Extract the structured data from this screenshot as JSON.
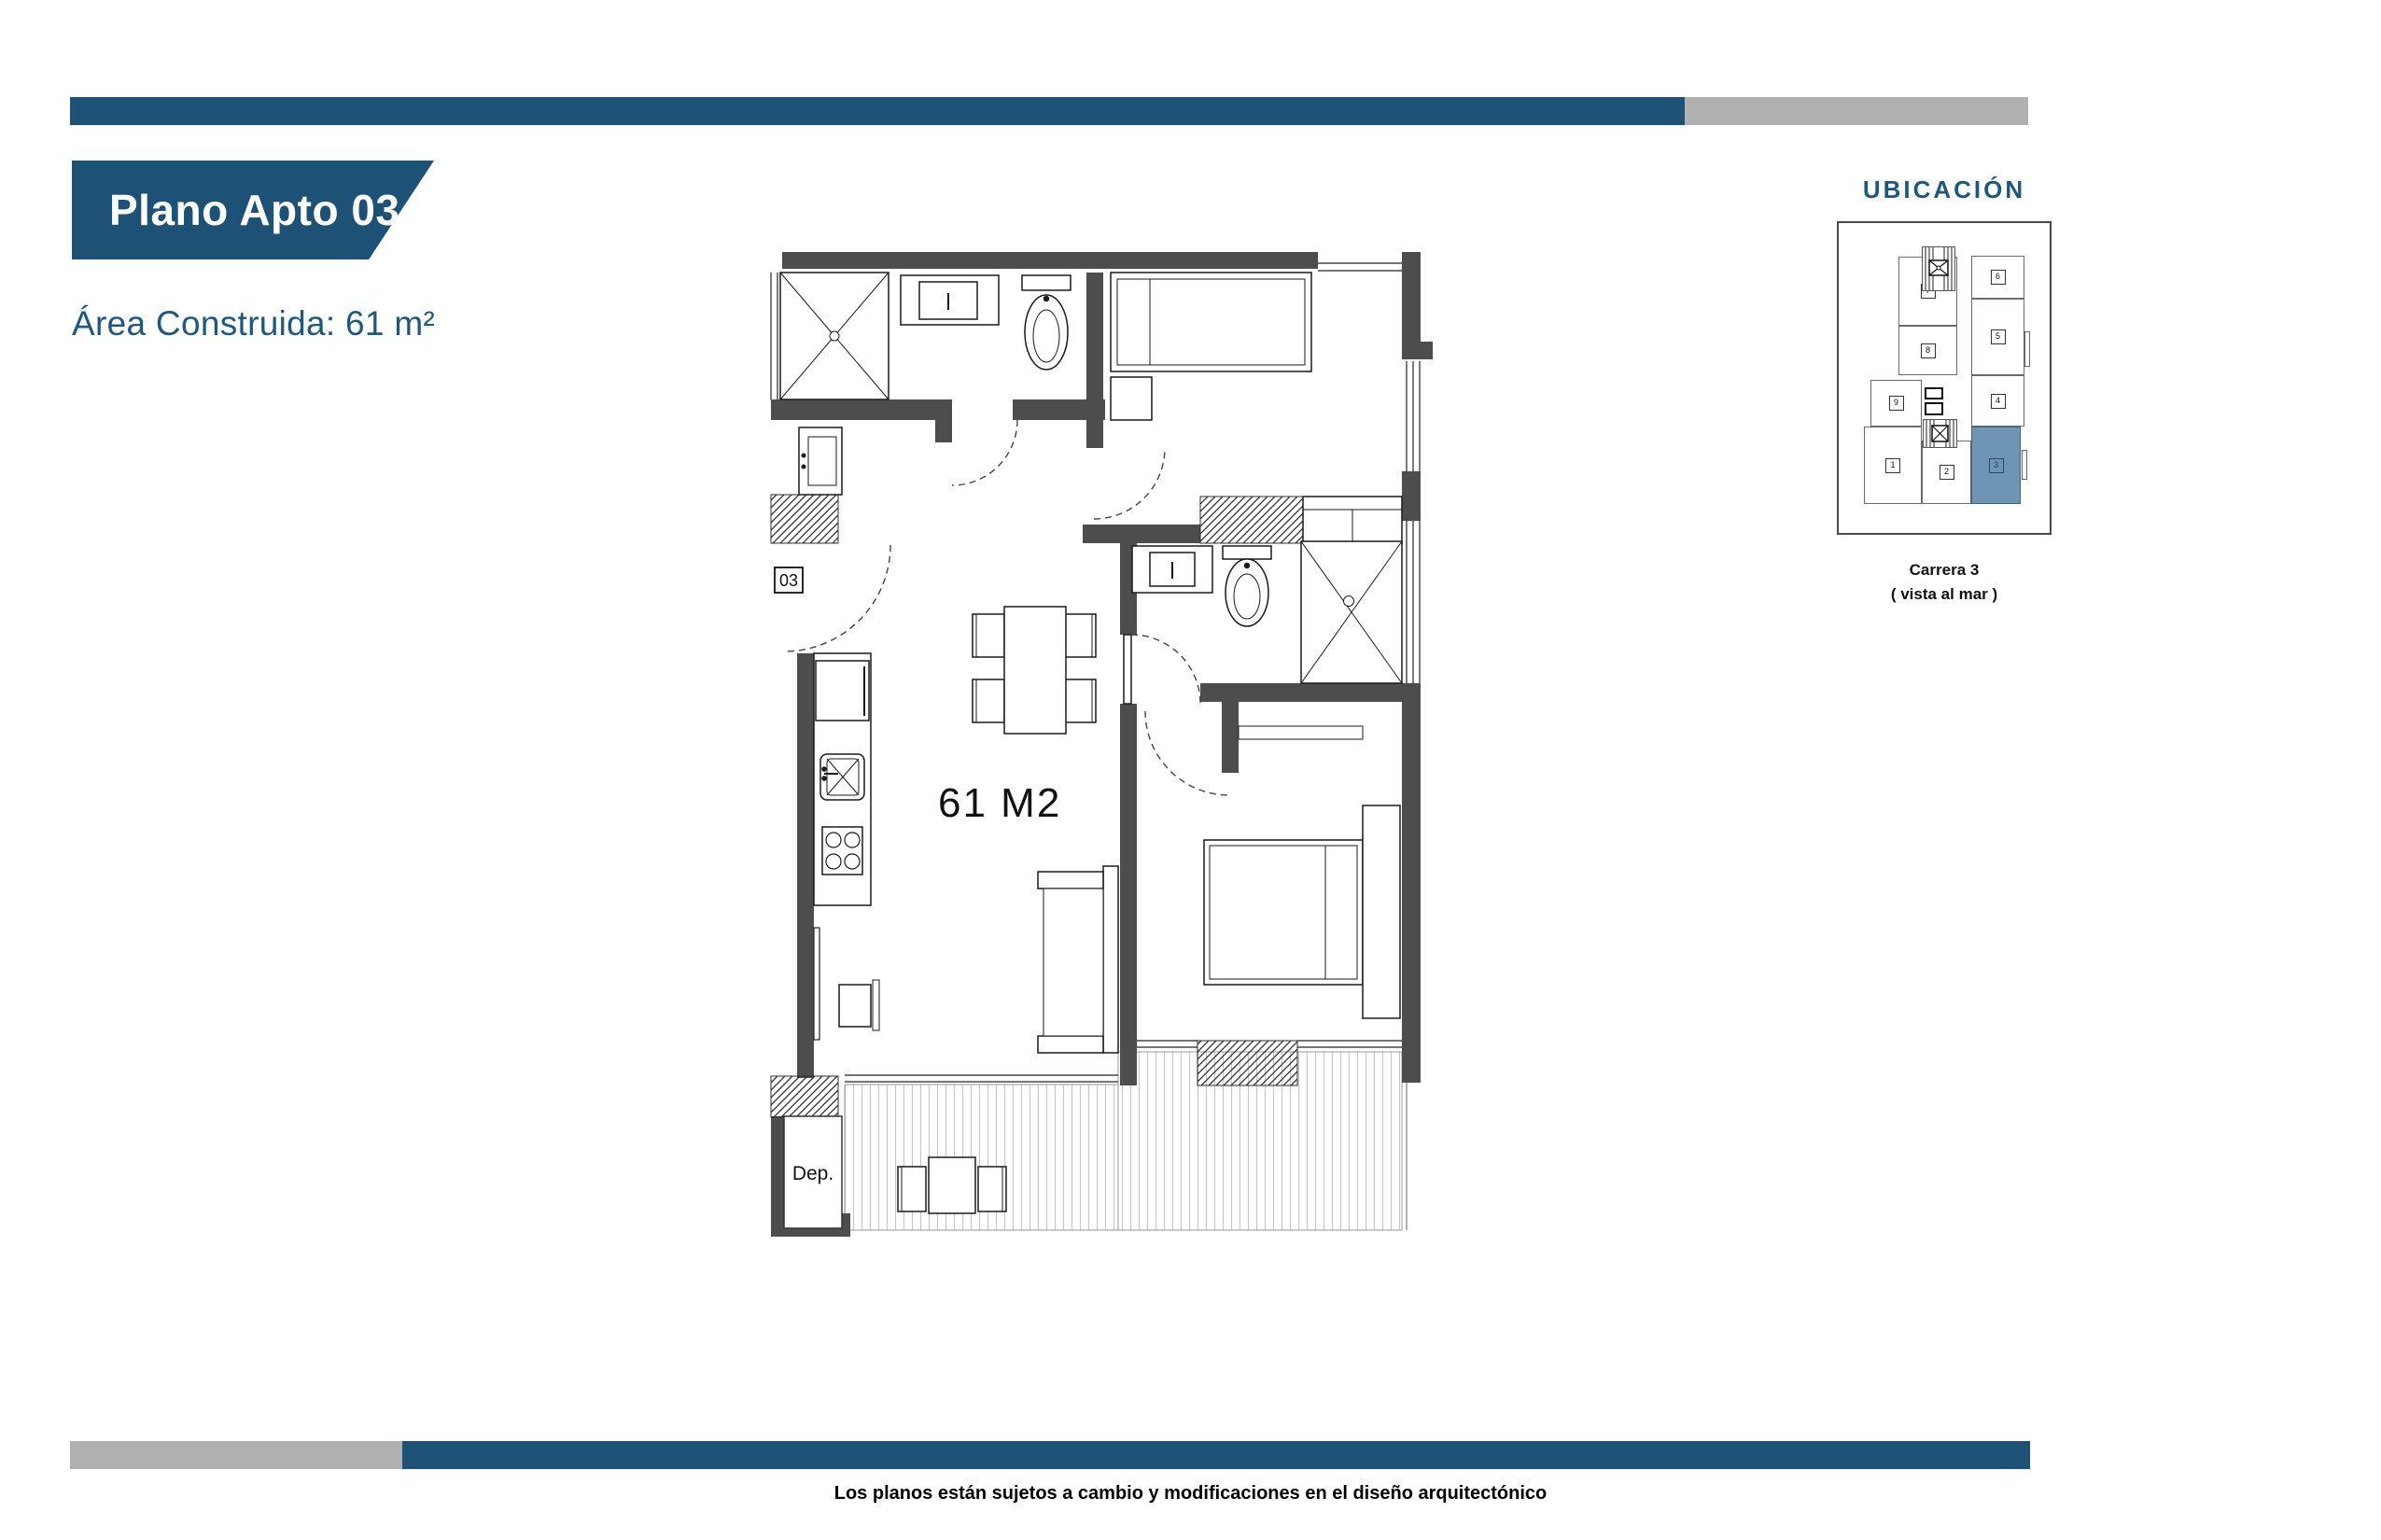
{
  "colors": {
    "accent_blue": "#1d5276",
    "heading_blue": "#1e587c",
    "bar_gray": "#b0b0b0",
    "wall_gray": "#4d4d4d",
    "unit_highlight_blue": "#6e96b4"
  },
  "header": {
    "banner_title": "Plano Apto 03",
    "area_label": "Área Construida: 61 m²"
  },
  "plan": {
    "apartment_label": "03",
    "area_label": "61 M2",
    "deposit_label": "Dep."
  },
  "location": {
    "title": "UBICACIÓN",
    "highlighted_unit": "3",
    "caption_line1": "Carrera 3",
    "caption_line2": "( vista al mar )",
    "units": [
      {
        "label": "1"
      },
      {
        "label": "2"
      },
      {
        "label": "3"
      },
      {
        "label": "4"
      },
      {
        "label": "5"
      },
      {
        "label": "6"
      },
      {
        "label": "7"
      },
      {
        "label": "8"
      },
      {
        "label": "9"
      }
    ]
  },
  "footer": {
    "disclaimer": "Los planos están sujetos a cambio y modificaciones en el diseño arquitectónico"
  }
}
